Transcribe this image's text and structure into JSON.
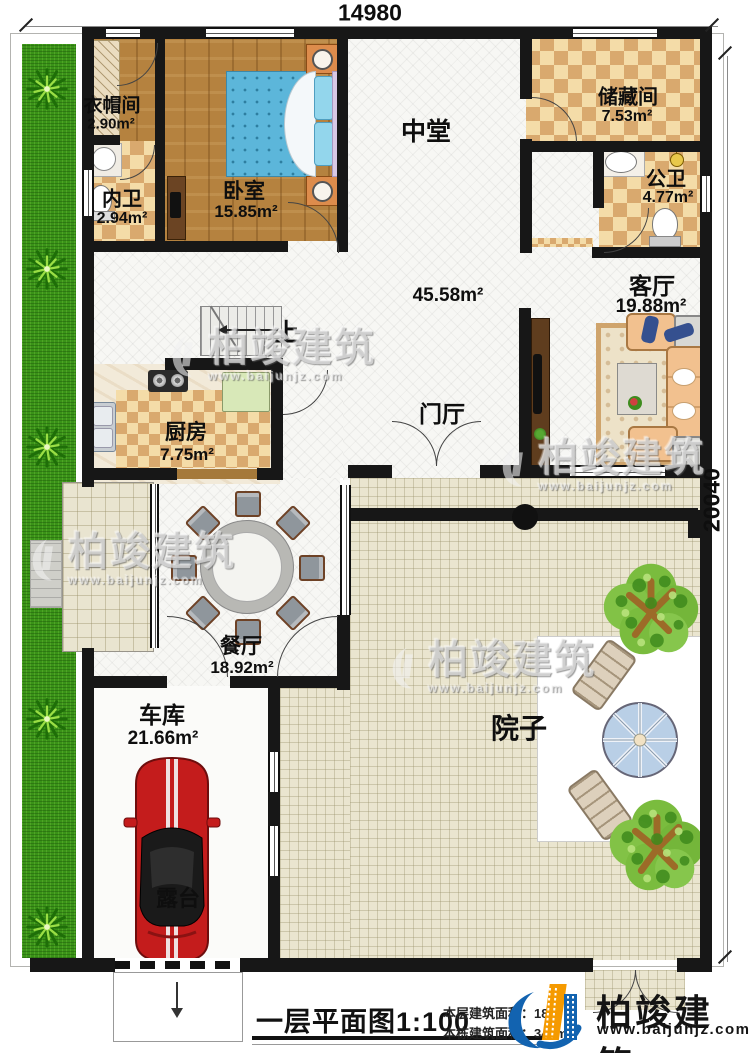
{
  "dimensions": {
    "width": "14980",
    "height": "20040"
  },
  "rooms": [
    {
      "name": "衣帽间",
      "area": "2.90m²"
    },
    {
      "name": "内卫",
      "area": "2.94m²"
    },
    {
      "name": "卧室",
      "area": "15.85m²"
    },
    {
      "name": "中堂",
      "area": "45.58m²"
    },
    {
      "name": "储藏间",
      "area": "7.53m²"
    },
    {
      "name": "公卫",
      "area": "4.77m²"
    },
    {
      "name": "客厅",
      "area": "19.88m²"
    },
    {
      "name": "门厅",
      "area": ""
    },
    {
      "name": "厨房",
      "area": "7.75m²"
    },
    {
      "name": "餐厅",
      "area": "18.92m²"
    },
    {
      "name": "车库",
      "area": "21.66m²"
    },
    {
      "name": "院子",
      "area": ""
    },
    {
      "name": "露台",
      "area": ""
    }
  ],
  "stairs": {
    "up_label": "上"
  },
  "footer": {
    "plan_title": "一层平面图",
    "scale": "1:100",
    "floor_area_label": "本层建筑面积：",
    "floor_area_value": "18",
    "building_area_label": "本栋建筑面积：",
    "building_area_value": "346m"
  },
  "brand": {
    "name": "柏竣建筑",
    "website": "www.baijunjz.com"
  },
  "colors": {
    "wall": "#171717",
    "lawn_green": "#3a9318",
    "checker_tan": "#d9a96e",
    "brand_blue": "#1263b0",
    "brand_orange": "#f59a00"
  }
}
